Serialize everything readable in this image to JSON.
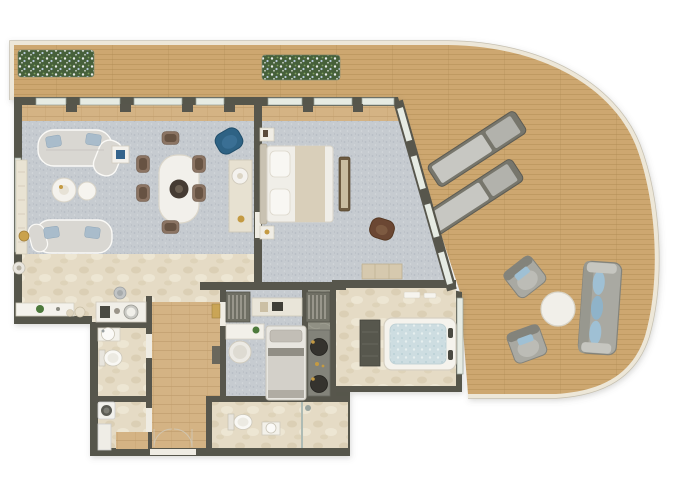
{
  "meta": {
    "title": "Penthouse Apartment Floor Plan",
    "description": "Top-down 2D rendered floor plan of a two-bedroom apartment with a wraparound curved timber sun deck. No text labels are rendered in the image.",
    "visible_text": []
  },
  "colors": {
    "bg": "#ffffff",
    "deckWood": "#cda76f",
    "deckLine": "#a98650",
    "deckRim": "#ede7d8",
    "deckEdge": "#c6c0b0",
    "wall": "#57564c",
    "window": "#e6ebe3",
    "windowFrame": "#98a096",
    "carpet": "#c6cbd0",
    "carpetDot1": "#b6bcc3",
    "carpetDot2": "#d4d8dc",
    "stone": "#e5dbc5",
    "stoneVein": "#d8cbae",
    "stoneLight": "#efe8d7",
    "wood": "#d4b384",
    "woodLine": "#bd9a69",
    "marbleDark": "#909084",
    "marbleVein": "#a3a396",
    "furnWhite": "#f3f1ec",
    "furnStroke": "#d2ccbf",
    "sofaGray": "#d9d7d2",
    "sofaOutline": "#fbfaf7",
    "pillowBlue": "#a9bccb",
    "accentBlue": "#2e6284",
    "chairBrown": "#8b7463",
    "chairSeat": "#63503f",
    "tableCenter": "#453b33",
    "headboard": "#c9c2b2",
    "linen": "#f0eee8",
    "runner": "#d9cfba",
    "benchWood": "#6d5b41",
    "benchPad": "#c9bda1",
    "brownChair": "#6b4733",
    "gold": "#c49a42",
    "water": "#cddde1",
    "waterDot": "#bad0d6",
    "planterGreen": "#46603a",
    "flowerWhite": "#e7ebe9",
    "flowerBlue": "#b7c8da",
    "leafLight": "#7fa05f",
    "outdoorGray": "#a9a9a2",
    "outdoorDark": "#83837b",
    "outdoorCushion": "#9fc0d4",
    "loungerBase": "#77766c",
    "loungerPadA": "#c7c7c2",
    "loungerPadB": "#b2b2ac",
    "steel": "#c1c4c5",
    "darkFixture": "#4a4a42",
    "closet": "#6f6f64",
    "closetStripe": "#b4b1a5",
    "doorLight": "#efece3",
    "glass": "#aebbb4"
  },
  "legend": {
    "rooms": [
      "terrace-deck",
      "living-room",
      "dining-area",
      "kitchen",
      "guest-wc",
      "laundry",
      "entrance-hall",
      "second-bedroom",
      "ensuite-vanity",
      "second-bathroom",
      "master-bedroom",
      "master-bathroom"
    ],
    "terrace_furniture": [
      "flower-planter-left",
      "flower-planter-right",
      "sun-lounger-1",
      "sun-lounger-2",
      "outdoor-armchair-1",
      "outdoor-armchair-2",
      "outdoor-round-table",
      "outdoor-sofa"
    ],
    "living_dining_furniture": [
      "curved-sofa-top",
      "curved-sofa-bottom",
      "side-table-blue",
      "coffee-table-large",
      "coffee-table-small",
      "floor-lamp",
      "shelf-unit",
      "dining-table",
      "dining-chairs-x6",
      "blue-armchair",
      "console-with-lamp"
    ],
    "kitchen_features": [
      "island-counter",
      "plant-pot",
      "jars",
      "appliance-counter",
      "coffee-machine",
      "steel-bowl"
    ],
    "master_bedroom_furniture": [
      "double-bed",
      "pillows",
      "bed-runner",
      "nightstand-top",
      "nightstand-bottom",
      "foot-bench",
      "brown-lounge-chair",
      "dresser"
    ],
    "second_bedroom_furniture": [
      "wardrobe-left",
      "wardrobe-right",
      "desk-with-laptop",
      "white-shelf",
      "pouf",
      "single-bed",
      "double-sink-vanity"
    ],
    "bathroom_fixtures": [
      "guest-wc-basin",
      "guest-wc-toilet",
      "washing-machine",
      "laundry-counter",
      "jacuzzi-bathtub",
      "bath-storage-column",
      "towels",
      "toilet-2",
      "washbasin-2",
      "shower",
      "entry-double-door"
    ]
  }
}
